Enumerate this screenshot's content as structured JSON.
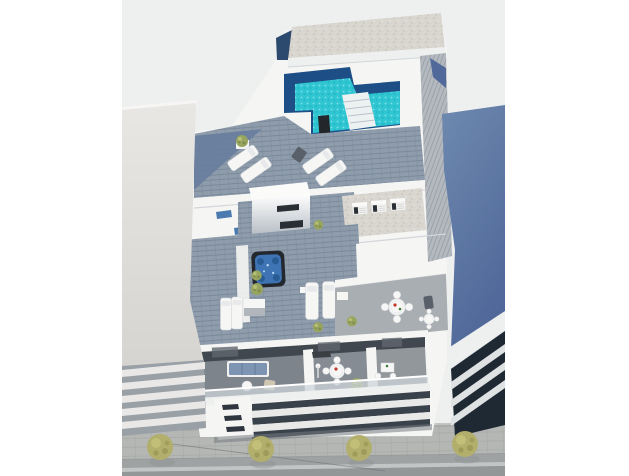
{
  "scene": {
    "title": "Aerial 3D architectural render of a modern apartment building rooftop",
    "view": "bird's-eye axonometric render, no text or UI elements",
    "features": [
      "rooftop solarium with L-shaped swimming pool and entry steps",
      "black outdoor shower column at pool edge",
      "gravel penthouse roof slab",
      "wood-plank roof terraces with white sun loungers and potted plants",
      "square hot tub with blue water",
      "stair core volume with dark slot windows",
      "three rooftop air-conditioning units on gravel pad",
      "second-floor terrace with round dining tables and chairs",
      "first-floor balconies: lounge sofa set, round dining set, bistro table",
      "white facade bands with dark recessed window strips",
      "neighbouring white building on the left with balcony slabs",
      "neighbouring blue-grey building on the right with louvered dark glazing",
      "sidewalk with four olive-green trees and asphalt road"
    ]
  },
  "colors": {
    "margin": "#ffffff",
    "background": "#eeefef",
    "white_wall": "#f5f5f3",
    "white_band": "#eef0ef",
    "roof_lip": "#f7f6f4",
    "shadow_line": "#d2d6da",
    "gravel": "#d9d6d0",
    "gravel_dot": "#c2beb6",
    "gravel_dot2": "#e9e7e1",
    "slab_navy": "#2c4a6e",
    "pool_navy": "#1d4f86",
    "pool_water": "#2fc6d2",
    "pool_sparkle": "#7fdfe7",
    "pool_deep_dot": "#1fb2c2",
    "pool_steps": "#eef1f2",
    "step_line": "#b9c2cb",
    "shower_black": "#23272c",
    "deck_plank": "#8e9cab",
    "deck_line": "#7b8a9b",
    "deck_shaded": "#687d9d",
    "ramp_gray": "#b3b9bf",
    "ramp_line": "#9aa2aa",
    "terrace_floor": "#a9aeb2",
    "balcony_floor1": "#7e848c",
    "balcony_floor2": "#868c93",
    "balcony_floor3": "#92979c",
    "dark_opening": "#40474f",
    "opening_light": "#5f666e",
    "facade_gap": "#39414b",
    "facade_band": "#e9eae8",
    "slit_dark": "#2f3640",
    "glass": "#ccd4d9",
    "core_face_top": "#ffffff",
    "core_face_bottom": "#99a2ac",
    "core_slot": "#2a2f35",
    "lightwell_blue": "#4a7ab0",
    "blue_wall_top": "#6e89af",
    "blue_wall_bottom": "#51699a",
    "blue_sliver": "#d7d4d0",
    "louver_dark": "#1f2933",
    "louver_white": "#dfe2e3",
    "left_wall_top": "#e9e7e4",
    "left_wall_bottom": "#d6d4d0",
    "left_stripe_base": "#99a0a6",
    "left_stripe": "#eae8e6",
    "sidewalk": "#b5b7b4",
    "pave_line": "#a6a8a6",
    "curb_light": "#c9cbc9",
    "curb_dark": "#999c9c",
    "road": "#9ea2a3",
    "road_line": "#c6c9c9",
    "road_low": "#939798",
    "cable": "#6d7277",
    "base_shadow": "#767c82",
    "tree_green": "#b2ae6b",
    "tree_dark": "#8f8c4f",
    "tree_light": "#c9c67e",
    "tree_shadow": "#8e9294",
    "bush_green": "#97a55e",
    "bush_dark": "#77864a",
    "bush_light": "#b9c27a",
    "furniture_white": "#f6f6f5",
    "furniture_edge": "#d8dbde",
    "pillow": "#e7e9ea",
    "sofa_blue": "#7d94b2",
    "sofa_frame": "#f0f0ee",
    "wicker": "#cfc6b2",
    "dark_chair": "#596069",
    "tub_shell": "#23282e",
    "tub_water": "#3f74b4",
    "tub_seat": "#2a5c94",
    "tub_sparkle": "#b8dcf2",
    "console_dark": "#3a3f44",
    "accent_red": "#c0392b",
    "accent_green": "#3f7d3a",
    "ac_body": "#f1f1ef",
    "ac_top": "#fafaf9",
    "planter_white": "#f3f3f1"
  }
}
